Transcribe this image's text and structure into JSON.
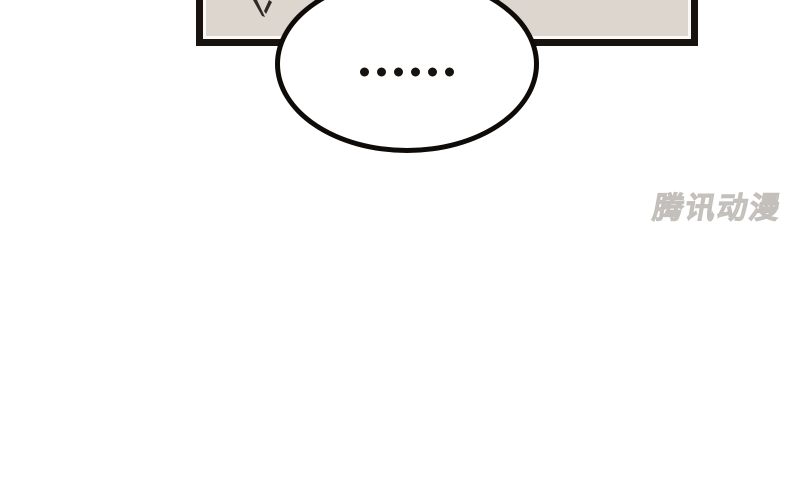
{
  "comic": {
    "panel": {
      "fill_color": "#dcd6cf",
      "border_color": "#18130f",
      "inner_line_color": "#faf9f7",
      "artwork": "hair-spike"
    },
    "speech_bubble": {
      "text": "……",
      "dot_count": 6,
      "fill_color": "#ffffff",
      "border_color": "#0e0b08",
      "dot_color": "#151210"
    },
    "watermark": {
      "text": "腾讯动漫",
      "color": "#dcd9d4"
    }
  }
}
